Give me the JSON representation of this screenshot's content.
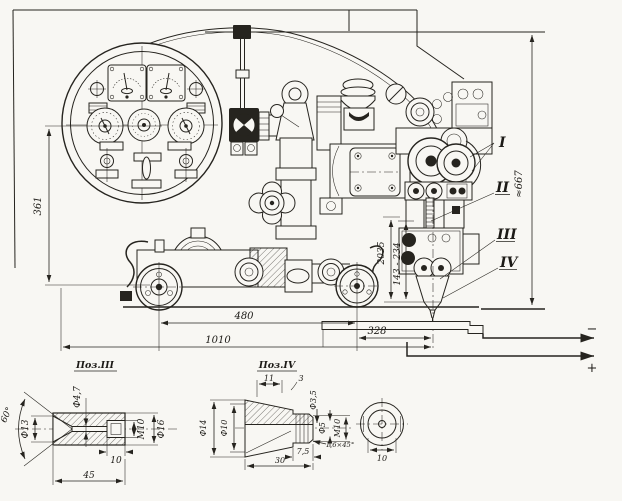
{
  "main_view": {
    "dims": {
      "d361": "361",
      "d667": "≈667",
      "d2035": "2035",
      "d_range": "143 - 234",
      "d480": "480",
      "d328": "328",
      "d1010": "1010"
    },
    "polarity": {
      "minus": "−",
      "plus": "+"
    },
    "callouts": {
      "i": "I",
      "ii": "II",
      "iii": "III",
      "iv": "IV"
    }
  },
  "detail_iii": {
    "title": "Поз.III",
    "dims": {
      "angle": "60°",
      "d13": "Ф13",
      "d4_7": "Ф4,7",
      "m10": "М10",
      "d16": "Ф16",
      "depth10": "10",
      "len45": "45"
    }
  },
  "detail_iv": {
    "title": "Поз.IV",
    "dims": {
      "len11": "11",
      "len3": "3",
      "d14": "Ф14",
      "d10": "Ф10",
      "d3_5": "Ф3,5",
      "d5": "Ф5",
      "m10": "М10",
      "chamfer": "1,6×45°",
      "len7_5": "7,5",
      "len30": "30",
      "dia10": "10"
    }
  }
}
